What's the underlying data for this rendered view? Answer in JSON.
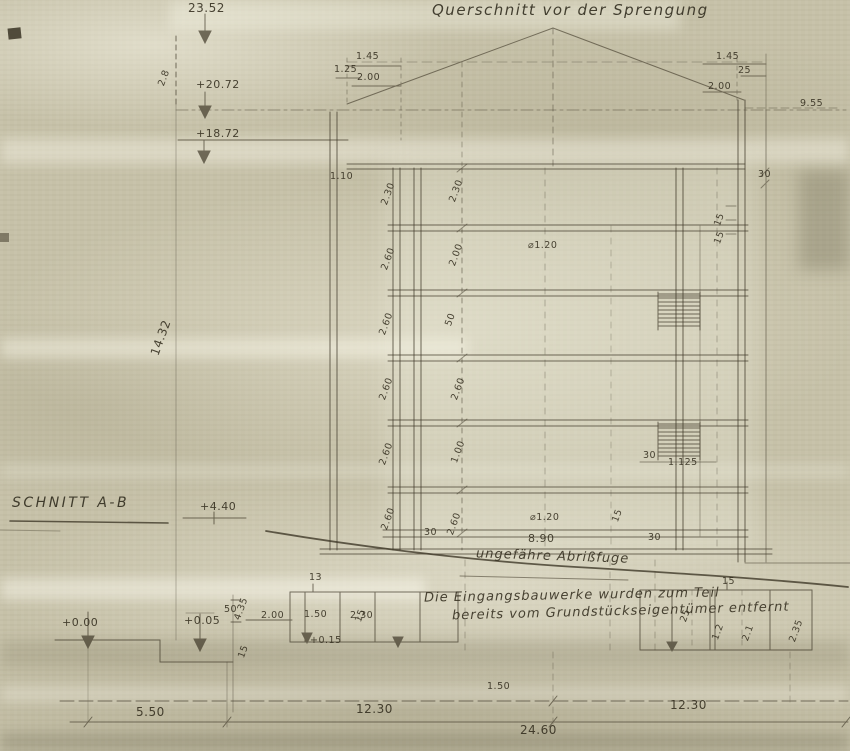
{
  "texts": {
    "title": "Querschnitt vor der Sprengung",
    "section": "SCHNITT A-B",
    "abriss": "ungefähre Abrißfuge",
    "note1": "Die Eingangsbauwerke wurden zum Teil",
    "note2": "bereits vom Grundstückseigentümer entfernt"
  },
  "elevation_marks": {
    "ridge": "23.52",
    "upper_left": "2.8",
    "eave": "+20.72",
    "attic": "+18.72",
    "left_total": "14.32",
    "mid": "+4.40",
    "ground": "+0.00",
    "entrance": "+0.05",
    "step": "+0.15"
  },
  "roof_dimensions": {
    "left": [
      "1.45",
      "1.25",
      "2.00"
    ],
    "right": [
      "1.45",
      "25",
      "2.00"
    ],
    "right_offset": "9.55",
    "parapet": "1.10"
  },
  "floor_dimensions": {
    "left": [
      "2.30",
      "2.60",
      "2.60",
      "2.60",
      "2.60",
      "2.60"
    ],
    "inner": [
      "2.30",
      "2.00",
      "50",
      "2.60",
      "1.00",
      "2.60"
    ]
  },
  "openings": {
    "door_upper": "⌀1.20",
    "door_lower": "⌀1.20",
    "width_lower": "8.90",
    "opening_right": "1.125"
  },
  "slab_ticks": {
    "a": "30",
    "b": "30",
    "c": "30",
    "d": "30",
    "e": "15",
    "f": "15",
    "g": "15"
  },
  "entrance_left": {
    "height": "4.35",
    "sill": "50",
    "depth": "2.00",
    "room_a": "1.50",
    "room_b": "2.30",
    "tick_13": "13",
    "tick_15a": "15",
    "tick_15b": "15"
  },
  "entrance_right": {
    "tick_15": "15",
    "tick_25": "25",
    "w1": "1.2",
    "w2": "2.1",
    "w3": "2.35"
  },
  "bottom_dimensions": {
    "annex": "5.50",
    "bay_left": "12.30",
    "total": "24.60",
    "bay_right": "12.30",
    "small": "1.50"
  }
}
